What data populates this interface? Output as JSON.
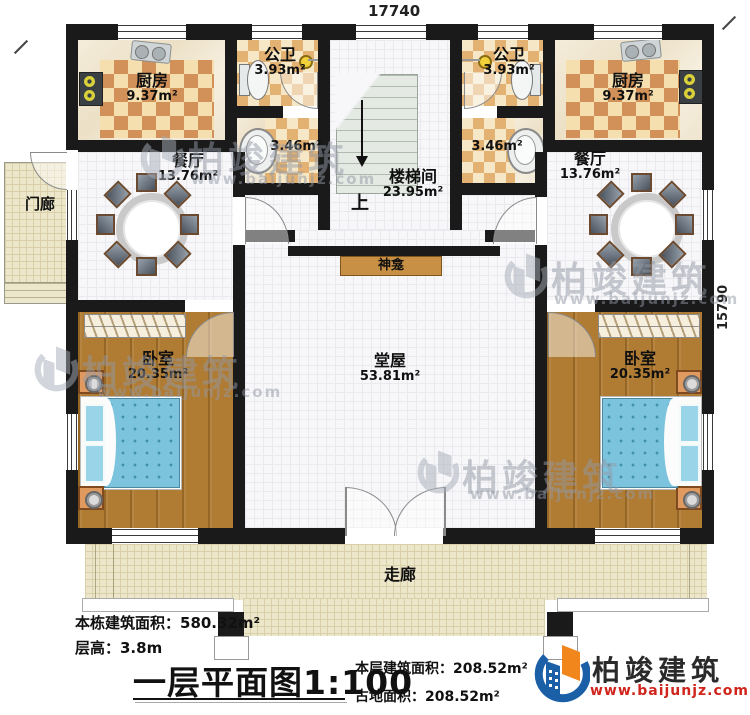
{
  "dimensions": {
    "top_width": "17740",
    "right_height": "15790"
  },
  "rooms": {
    "kitchen_left": {
      "name": "厨房",
      "area": "9.37m²"
    },
    "kitchen_right": {
      "name": "厨房",
      "area": "9.37m²"
    },
    "bathroom_left": {
      "name": "公卫",
      "area": "3.93m²"
    },
    "bathroom_right": {
      "name": "公卫",
      "area": "3.93m²"
    },
    "washroom_left": {
      "area": "3.46m²"
    },
    "washroom_right": {
      "area": "3.46m²"
    },
    "dining_left": {
      "name": "餐厅",
      "area": "13.76m²"
    },
    "dining_right": {
      "name": "餐厅",
      "area": "13.76m²"
    },
    "stairwell": {
      "name": "楼梯间",
      "area": "23.95m²",
      "direction": "上"
    },
    "hall": {
      "name": "堂屋",
      "area": "53.81m²"
    },
    "shrine": {
      "name": "神龛"
    },
    "bedroom_left": {
      "name": "卧室",
      "area": "20.35m²"
    },
    "bedroom_right": {
      "name": "卧室",
      "area": "20.35m²"
    },
    "porch": {
      "name": "门廊"
    },
    "corridor": {
      "name": "走廊"
    }
  },
  "footer": {
    "total_area": "本栋建筑面积：580.32m²",
    "floor_height": "层高：3.8m",
    "title": "一层平面图",
    "scale": "1:100",
    "floor_area": "本层建筑面积：208.52m²",
    "land_area": "占地面积：208.52m²"
  },
  "brand": {
    "name": "柏竣建筑",
    "url": "www.baijunjz.com"
  },
  "watermark": {
    "name": "柏竣建筑",
    "url": "www.baijunjz.com"
  },
  "colors": {
    "brand_blue": "#1b5fa7",
    "brand_orange": "#f0861c",
    "brand_red": "#d0251c",
    "wall": "#1a1a1a"
  }
}
